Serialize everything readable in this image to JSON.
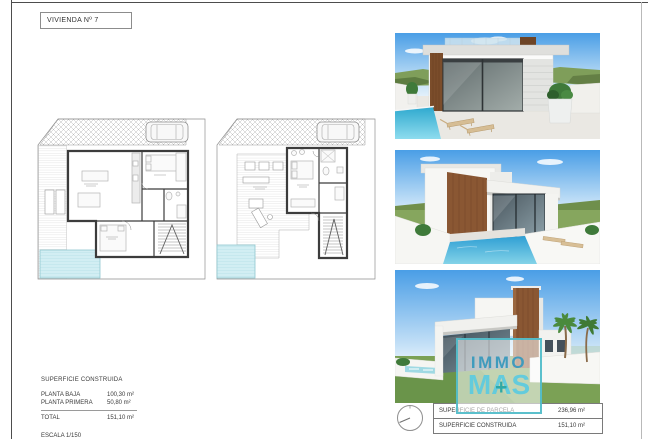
{
  "sheet": {
    "title": "VIVIENDA Nº 7"
  },
  "surface_summary": {
    "heading": "SUPERFICIE CONSTRUIDA",
    "rows": [
      {
        "label": "PLANTA BAJA",
        "value": "100,30 m²"
      },
      {
        "label": "PLANTA PRIMERA",
        "value": "50,80 m²"
      }
    ],
    "total_label": "TOTAL",
    "total_value": "151,10 m²",
    "scale": "ESCALA 1/150"
  },
  "parcel_table": {
    "rows": [
      {
        "label": "SUPERFICIE DE PARCELA",
        "value": "236,96 m²"
      },
      {
        "label": "SUPERFICIE CONSTRUIDA",
        "value": "151,10 m²"
      }
    ]
  },
  "logo": {
    "immo": "IMMO",
    "m": "M",
    "a": "A",
    "s": "S",
    "plus": "+",
    "immo_color": "#3f9bbd",
    "mas_color": "#63cbdc",
    "plus_color": "#2fa8a4",
    "border_color": "#49b9c7"
  },
  "figures": {
    "floor_plans": [
      "planta-baja-plan",
      "planta-primera-plan"
    ],
    "renders": [
      "front-pool-render",
      "side-pool-render",
      "corner-street-render"
    ],
    "compass_icon": "north-indicator"
  },
  "colors": {
    "pool": "#cdeef3",
    "render_pool": "#2fa9cf",
    "wood_accent": "#8a5733",
    "sky_top": "#4a9ee6",
    "grass": "#7ba155"
  }
}
